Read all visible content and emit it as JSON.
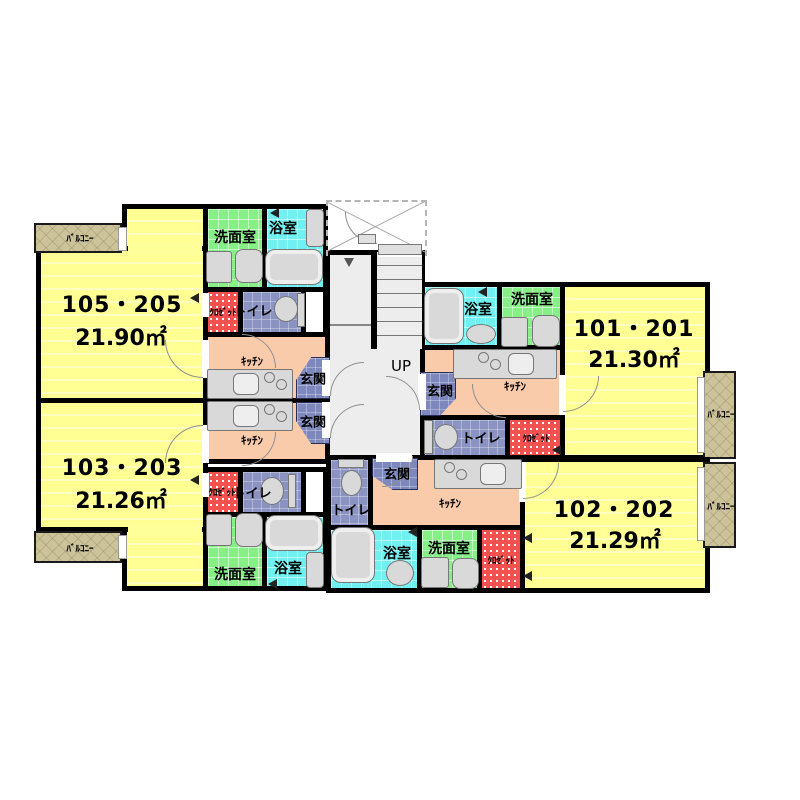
{
  "plan": {
    "units": {
      "u105": {
        "name": "105・205",
        "area": "21.90㎡"
      },
      "u101": {
        "name": "101・201",
        "area": "21.30㎡"
      },
      "u103": {
        "name": "103・203",
        "area": "21.26㎡"
      },
      "u102": {
        "name": "102・202",
        "area": "21.29㎡"
      }
    },
    "labels": {
      "washroom": "洗面室",
      "bathroom": "浴室",
      "toilet": "トイレ",
      "closet": "ｸﾛｾﾞｯﾄ",
      "kitchen": "ｷｯﾁﾝ",
      "entrance": "玄関",
      "balcony": "ﾊﾞﾙｺﾆｰ",
      "stairs_up": "UP"
    },
    "colors": {
      "room_yellow": "#ffff99",
      "washroom_green": "#86ef86",
      "bathroom_cyan": "#70f0f0",
      "toilet_blue": "#8a93c2",
      "closet_red": "#f35050",
      "kitchen_peach": "#f9cbaa",
      "balcony_tan": "#ccc39b",
      "stair_hall_gray": "#ededed",
      "wall": "#000000"
    }
  }
}
